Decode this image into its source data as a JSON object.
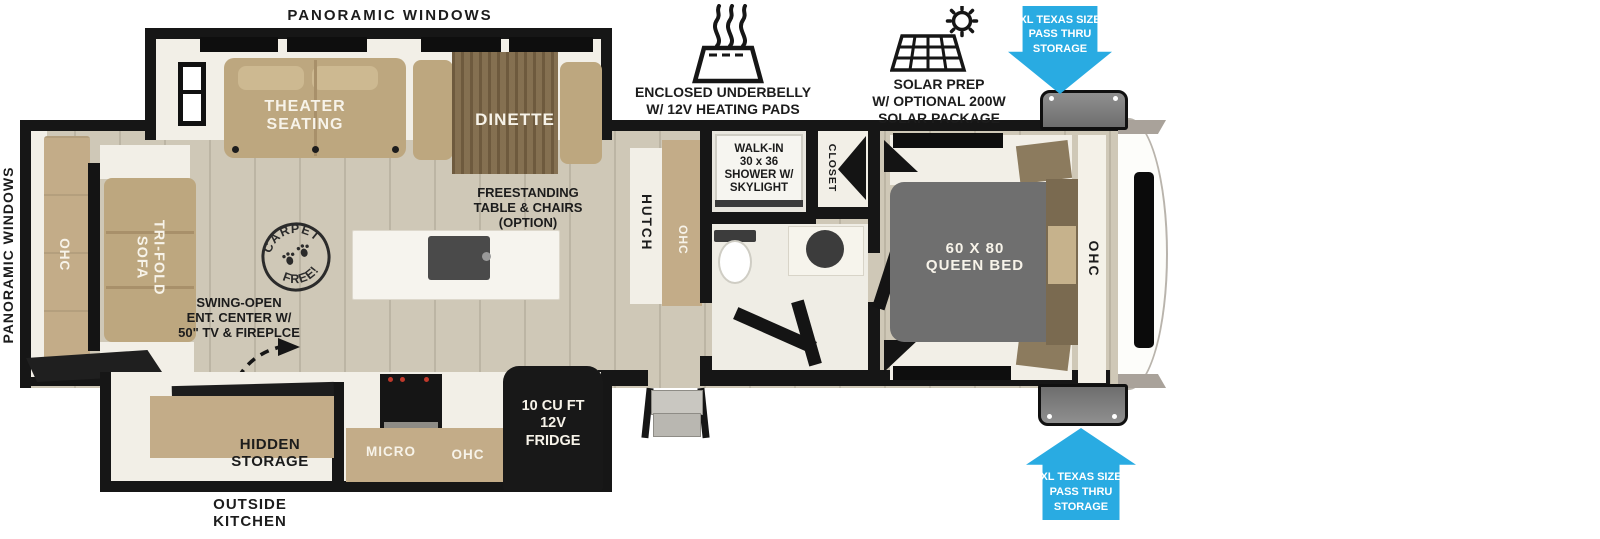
{
  "title": "Travel trailer floor plan",
  "labels": {
    "panoramic_windows_top": "PANORAMIC WINDOWS",
    "panoramic_windows_rear": "PANORAMIC WINDOWS",
    "theater_seating": "THEATER\nSEATING",
    "dinette": "DINETTE",
    "tri_fold_sofa": "TRI-FOLD\nSOFA",
    "rear_ohc": "OHC",
    "hutch": "HUTCH",
    "hutch_ohc": "OHC",
    "walk_in_shower": "WALK-IN\n30 x 36\nSHOWER W/\nSKYLIGHT",
    "closet": "CLOSET",
    "queen_bed": "60 X 80\nQUEEN BED",
    "bedroom_ohc": "OHC",
    "freestanding_table": "FREESTANDING\nTABLE & CHAIRS\n(OPTION)",
    "swing_open_ent": "SWING-OPEN\nENT. CENTER W/\n50\" TV & FIREPLCE",
    "carpet_free_top": "CARPET",
    "carpet_free_bottom": "FREE!",
    "hidden_storage": "HIDDEN\nSTORAGE",
    "outside_kitchen": "OUTSIDE\nKITCHEN",
    "micro": "MICRO",
    "kitchen_ohc": "OHC",
    "fridge": "10 CU FT\n12V\nFRIDGE"
  },
  "callouts": {
    "enclosed_underbelly": "ENCLOSED UNDERBELLY\nW/ 12V HEATING PADS",
    "solar_prep": "SOLAR PREP\nW/ OPTIONAL 200W\nSOLAR PACKAGE",
    "pass_thru_top": "XL TEXAS SIZE\nPASS THRU\nSTORAGE",
    "pass_thru_bottom": "XL TEXAS SIZE\nPASS THRU\nSTORAGE"
  },
  "icons": {
    "underbelly": "heating-pad-steam-icon",
    "solar": "solar-panel-sun-icon",
    "pass_thru_top": "arrow-down-callout",
    "pass_thru_bottom": "arrow-up-callout",
    "swing_arrow": "dashed-curved-arrow",
    "carpet_badge": "carpet-free-stamp"
  },
  "colors": {
    "accent_blue": "#29ABE2",
    "wall_black": "#161616",
    "floor_wood": "#CFC8B7",
    "cabinet_tan": "#C3AC88",
    "sofa_tan": "#BDA77F",
    "table_wood": "#7D6746",
    "bed_gray": "#6F6F6F",
    "appliance_black": "#181818",
    "interior_white": "#F2EFE7"
  }
}
